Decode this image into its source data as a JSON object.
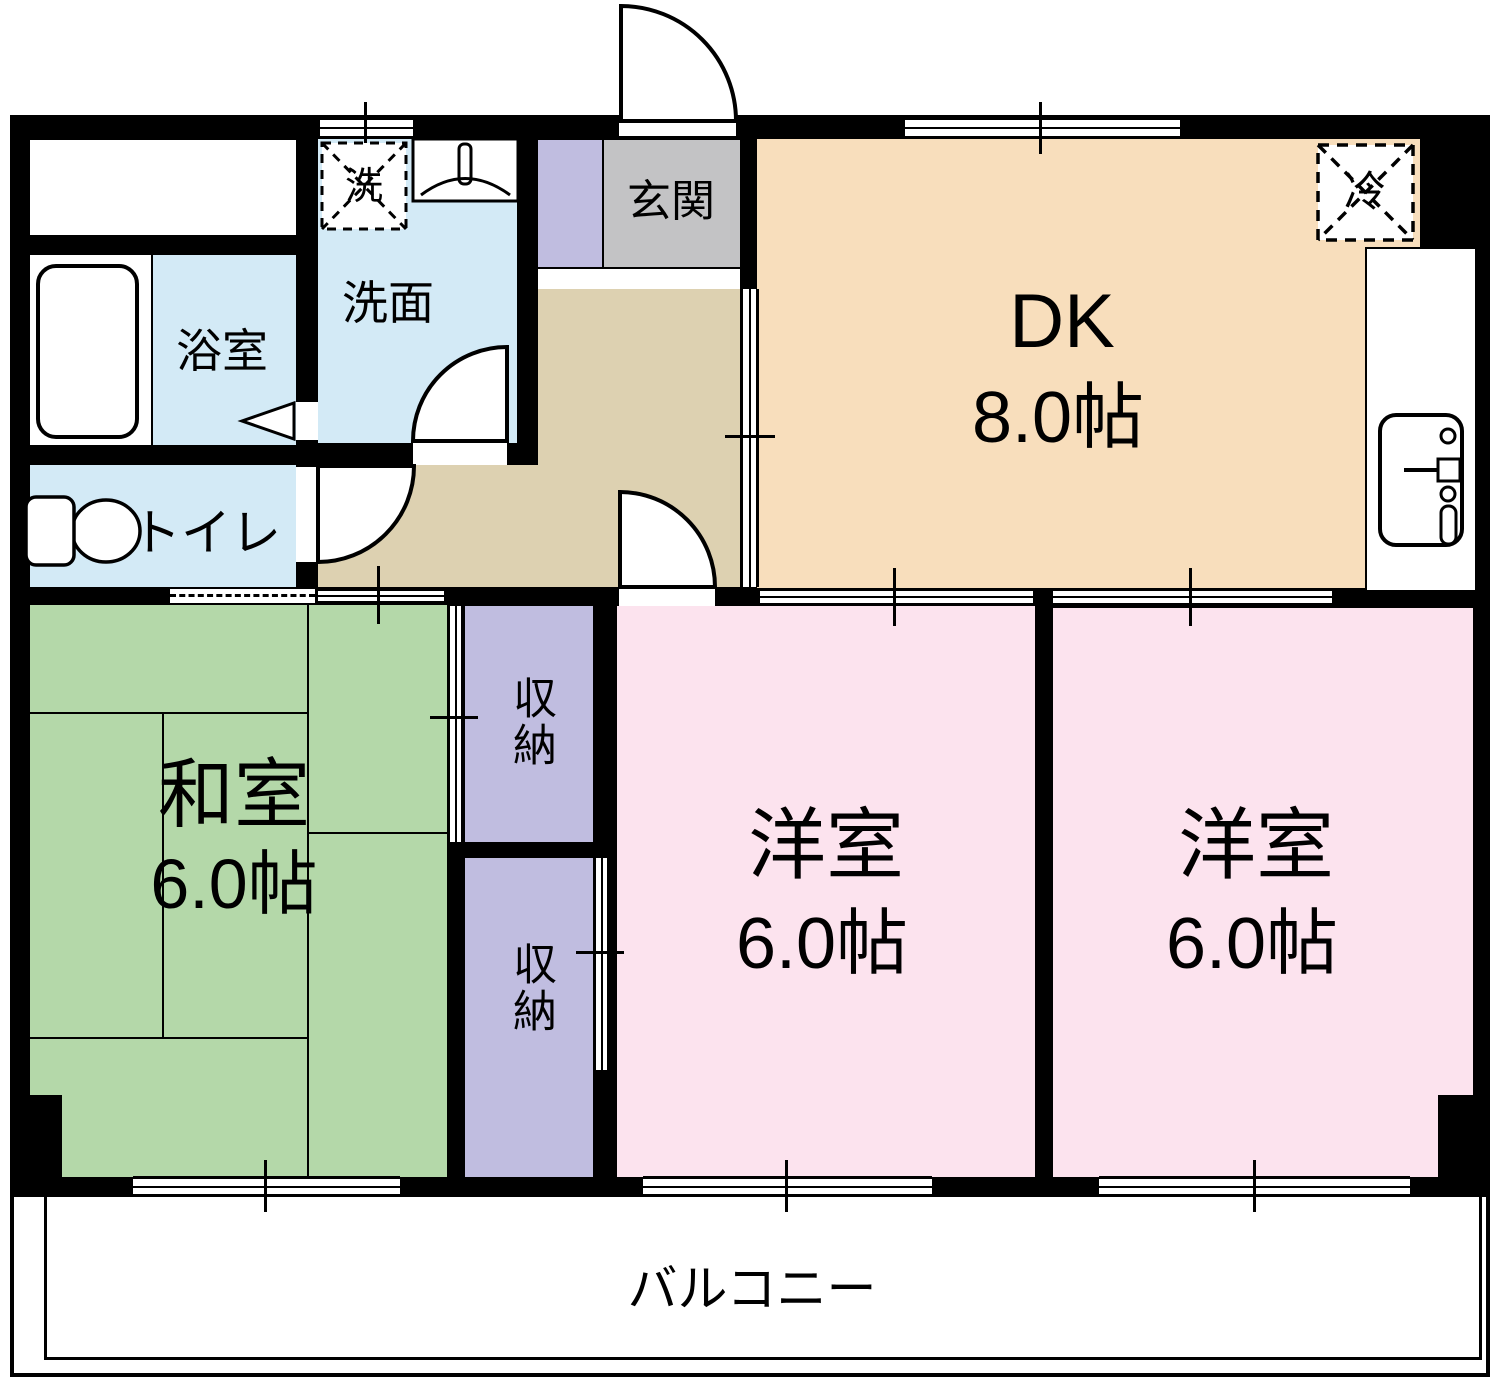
{
  "title": "3DK apartment floor plan",
  "colors": {
    "wall": "#000000",
    "wet_rooms": "#d3eaf6",
    "tatami_room": "#b4d8a9",
    "western_room": "#fce3ee",
    "storage": "#c0bde0",
    "hallway": "#ddd1b1",
    "dining_kitchen": "#f8debc",
    "entrance": "#c3c3c5",
    "balcony": "#ffffff"
  },
  "rooms": {
    "dk": {
      "label": "DK",
      "size": "8.0帖"
    },
    "washitsu": {
      "label": "和室",
      "size": "6.0帖"
    },
    "western1": {
      "label": "洋室",
      "size": "6.0帖"
    },
    "western2": {
      "label": "洋室",
      "size": "6.0帖"
    },
    "genkan": {
      "label": "玄関"
    },
    "senmen": {
      "label": "洗面"
    },
    "bath": {
      "label": "浴室"
    },
    "toilet": {
      "label": "トイレ"
    },
    "storage1": {
      "label": "収納"
    },
    "storage2": {
      "label": "収納"
    },
    "balcony": {
      "label": "バルコニー"
    }
  },
  "fixtures": {
    "washer": {
      "label": "洗"
    },
    "fridge": {
      "label": "冷"
    }
  }
}
